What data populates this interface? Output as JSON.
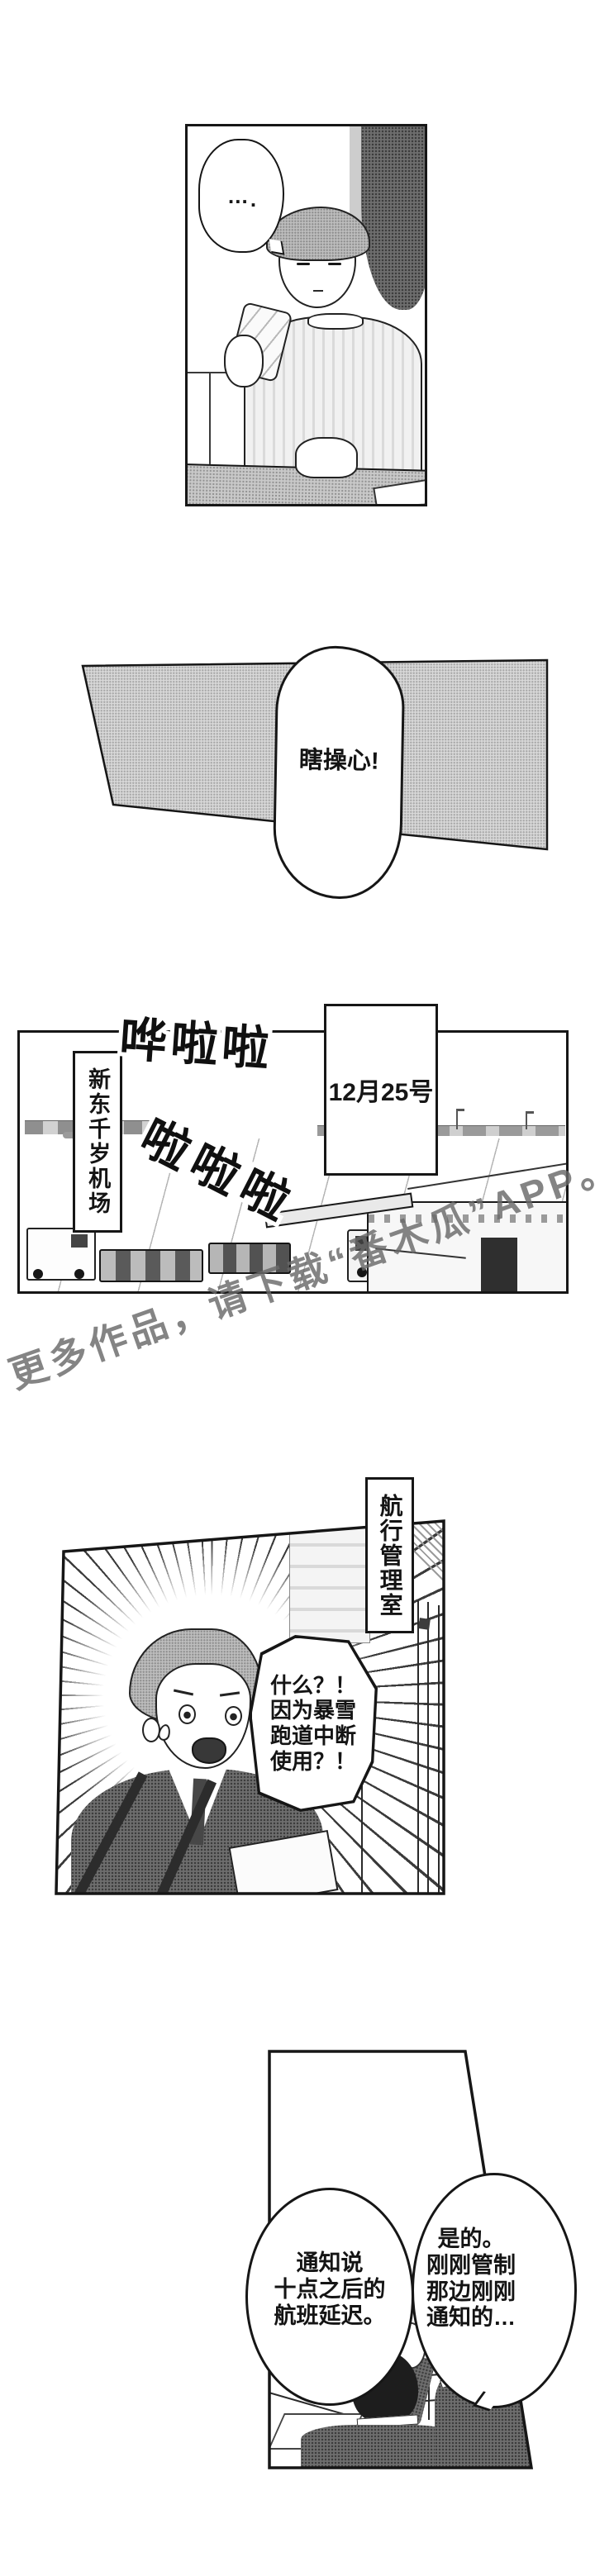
{
  "page": {
    "bg": "#ffffff",
    "ink": "#161616",
    "halftone_light": "#e2e2e2",
    "halftone_mid": "#d8d8d8",
    "halftone_dark": "#6e6e6e"
  },
  "watermark": {
    "text": "更多作品，请下载“番木瓜”APP。",
    "color": "#696969"
  },
  "panel1": {
    "bubble_dots": "…",
    "bubble_extra_dot": "."
  },
  "panel2": {
    "bubble_text": "瞎操心!"
  },
  "panel3": {
    "sfx_top": "哗啦啦",
    "sfx_mid": "啦啦啦",
    "date_label": "12月25号",
    "location_label": "新东千岁机场"
  },
  "panel4": {
    "room_label": "航行管理室",
    "bubble_lines": [
      "什么？！",
      "因为暴雪",
      "跑道中断",
      "使用？！"
    ]
  },
  "panel5": {
    "left_bubble_lines": [
      "通知说",
      "十点之后的",
      "航班延迟。"
    ],
    "right_bubble_lines": [
      "是的。",
      "刚刚管制",
      "那边刚刚",
      "通知的…"
    ]
  }
}
